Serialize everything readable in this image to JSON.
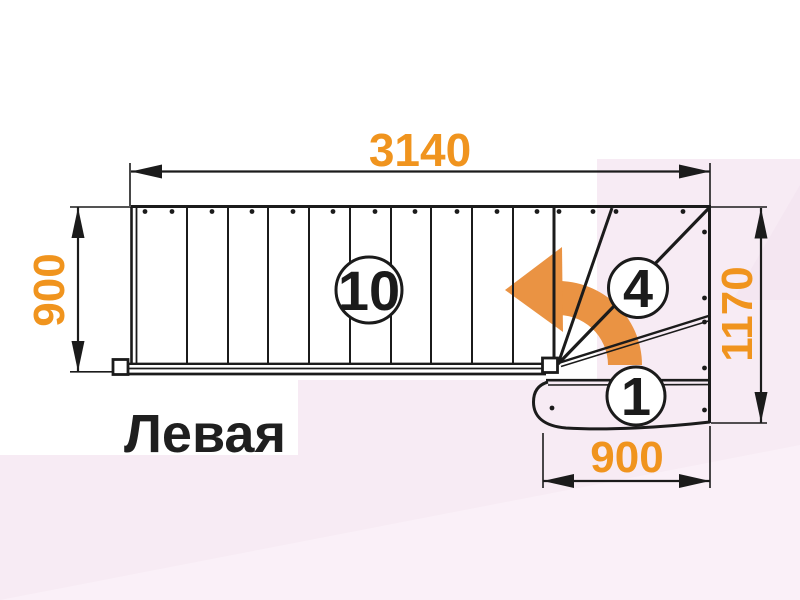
{
  "drawing": {
    "title": "Левая",
    "dimensions": {
      "top_length": "3140",
      "left_width": "900",
      "right_height": "1170",
      "bottom_width": "900"
    },
    "step_markers": {
      "straight_flight": "10",
      "winders": "4",
      "bottom_step": "1"
    },
    "icons": {
      "turn_arrow": "curved-turn-left-arrow-icon"
    },
    "colors": {
      "dimension_text": "#F0941E",
      "turn_arrow_fill": "#EA9343",
      "line_color": "#1B1B1B",
      "title_text": "#1F1F1F",
      "background_base": "#FFFFFF",
      "background_pink": "#F7EBF4",
      "background_pink_light": "#FAF1F8"
    }
  }
}
